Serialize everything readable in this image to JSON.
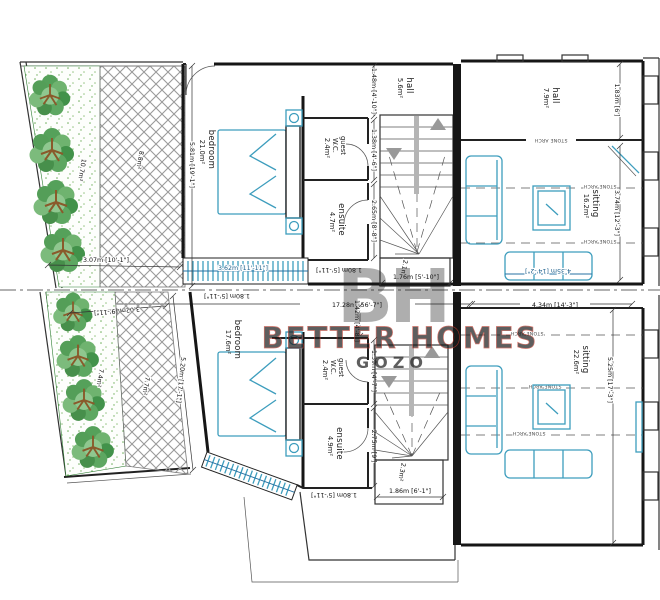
{
  "wm": {
    "logo": "BH",
    "line1": "BETTER HOMES",
    "line2": "GOZO"
  },
  "mid": {
    "total_dim": "17.28m [56'-7\"]",
    "right_dim": "4.34m [14'-3\"]",
    "hall_dim": "1.42m [4'-8\"]"
  },
  "up": {
    "garden": {
      "area": "10.7m²"
    },
    "yard": {
      "area": "8.8m²",
      "width_dim": "3.07m [10'-1\"]"
    },
    "bedroom": {
      "label": "bedroom",
      "area": "21.0m²",
      "depth_dim": "5.81m [19'-1\"]",
      "window_dim": "3.62m [11'-11\"]"
    },
    "guest_wc": {
      "line1": "guest",
      "line2": "W.C.",
      "area": "2.4m²",
      "dim": "1.38m [4'-6\"]"
    },
    "ensuite": {
      "label": "ensuite",
      "area": "4.7m²",
      "dim": "2.65m [8'-8\"]",
      "width_dim": "1.80m [5'-11\"]"
    },
    "hall": {
      "label": "hall",
      "area": "5.6m²",
      "dim": "1.48m [4'-10\"]"
    },
    "shaft": {
      "area": "2.1m²",
      "dim": "1.76m [5'-10\"]"
    },
    "rear_hall": {
      "label": "hall",
      "area": "7.9m²",
      "dim": "1.83m [6']"
    },
    "sitting": {
      "label": "sitting",
      "area": "16.2m²",
      "depth_dim": "3.74m [12'-3\"]",
      "width_dim": "4.35m [14'-2\"]"
    },
    "stone_arch": "STONE ARCH"
  },
  "lo": {
    "garden": {
      "area": "7.4m²",
      "width_dim": "3.02m [9'-11\"]"
    },
    "yard": {
      "area": "7.7m²",
      "side_dim": "5.20m [17'-1\"]"
    },
    "bedroom": {
      "label": "bedroom",
      "area": "17.6m²",
      "front_dim": "1.80m [5'-11\"]"
    },
    "guest_wc": {
      "line1": "guest",
      "line2": "W.C.",
      "area": "2.4m²",
      "dim": "1.39m [4'-7\"]"
    },
    "ensuite": {
      "label": "ensuite",
      "area": "4.9m²",
      "dim": "2.75m [9']",
      "width_dim": "1.80m [5'-11\"]"
    },
    "shaft": {
      "area": "2.3m²",
      "dim": "1.86m [6'-1\"]"
    },
    "sitting": {
      "label": "sitting",
      "area": "22.6m²",
      "depth_dim": "5.25m [17'-3\"]"
    },
    "stone_arch": "STONE ARCH"
  }
}
